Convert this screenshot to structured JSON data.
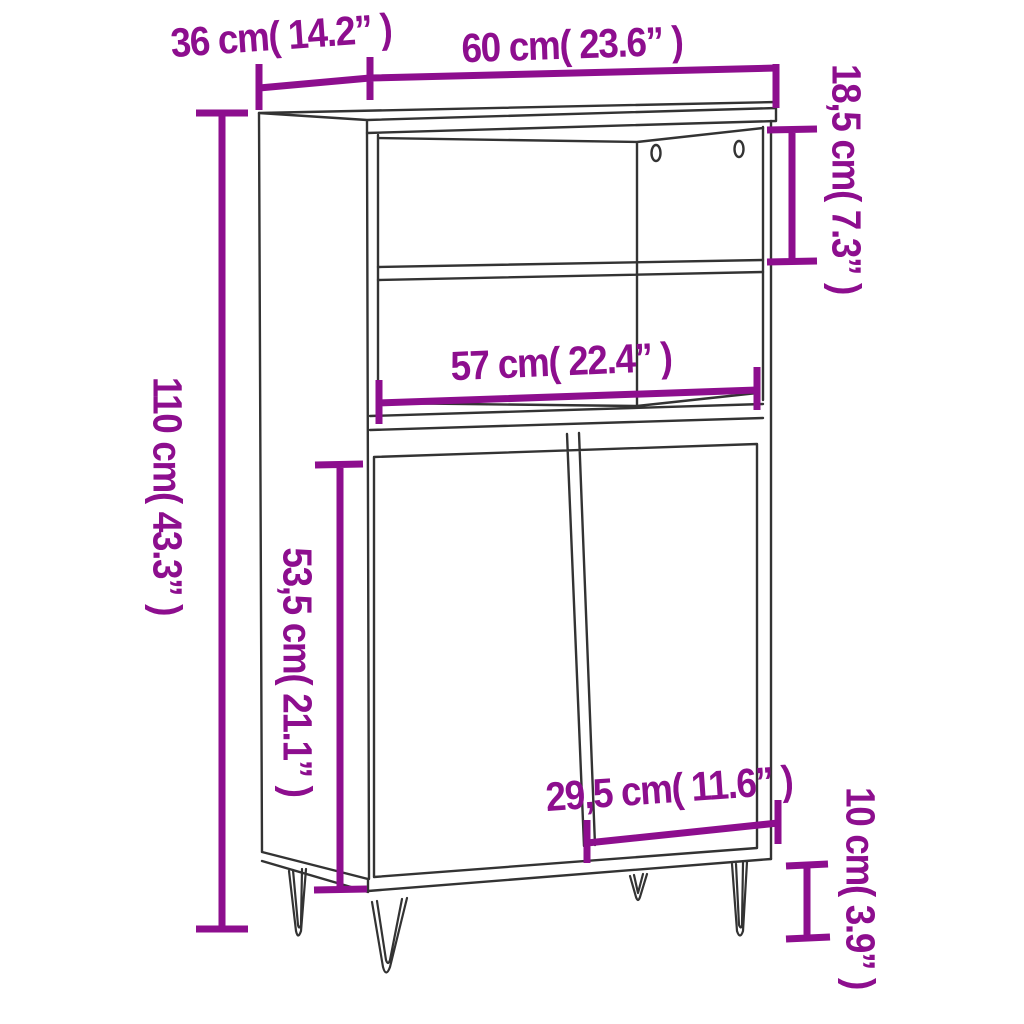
{
  "diagram": {
    "title": "highboard-dimension-diagram",
    "product": "highboard cabinet with open shelves, two doors and hairpin legs",
    "background_color": "#ffffff",
    "line_color": "#333333",
    "accent_color": "#8D0E8E",
    "dimensions": [
      {
        "id": "depth",
        "label": "36 cm( 14.2” )",
        "cm": "36",
        "inch": "14.2",
        "orientation": "horizontal"
      },
      {
        "id": "width",
        "label": "60 cm( 23.6” )",
        "cm": "60",
        "inch": "23.6",
        "orientation": "horizontal"
      },
      {
        "id": "top-shelf-height",
        "label": "18,5 cm( 7.3” )",
        "cm": "18,5",
        "inch": "7.3",
        "orientation": "vertical"
      },
      {
        "id": "total-height",
        "label": "110 cm( 43.3” )",
        "cm": "110",
        "inch": "43.3",
        "orientation": "vertical"
      },
      {
        "id": "inner-width",
        "label": "57 cm( 22.4” )",
        "cm": "57",
        "inch": "22.4",
        "orientation": "horizontal"
      },
      {
        "id": "door-height",
        "label": "53,5 cm( 21.1” )",
        "cm": "53,5",
        "inch": "21.1",
        "orientation": "vertical"
      },
      {
        "id": "door-width",
        "label": "29,5 cm( 11.6” )",
        "cm": "29,5",
        "inch": "11.6",
        "orientation": "horizontal"
      },
      {
        "id": "leg-height",
        "label": "10 cm( 3.9” )",
        "cm": "10",
        "inch": "3.9",
        "orientation": "vertical"
      }
    ]
  }
}
